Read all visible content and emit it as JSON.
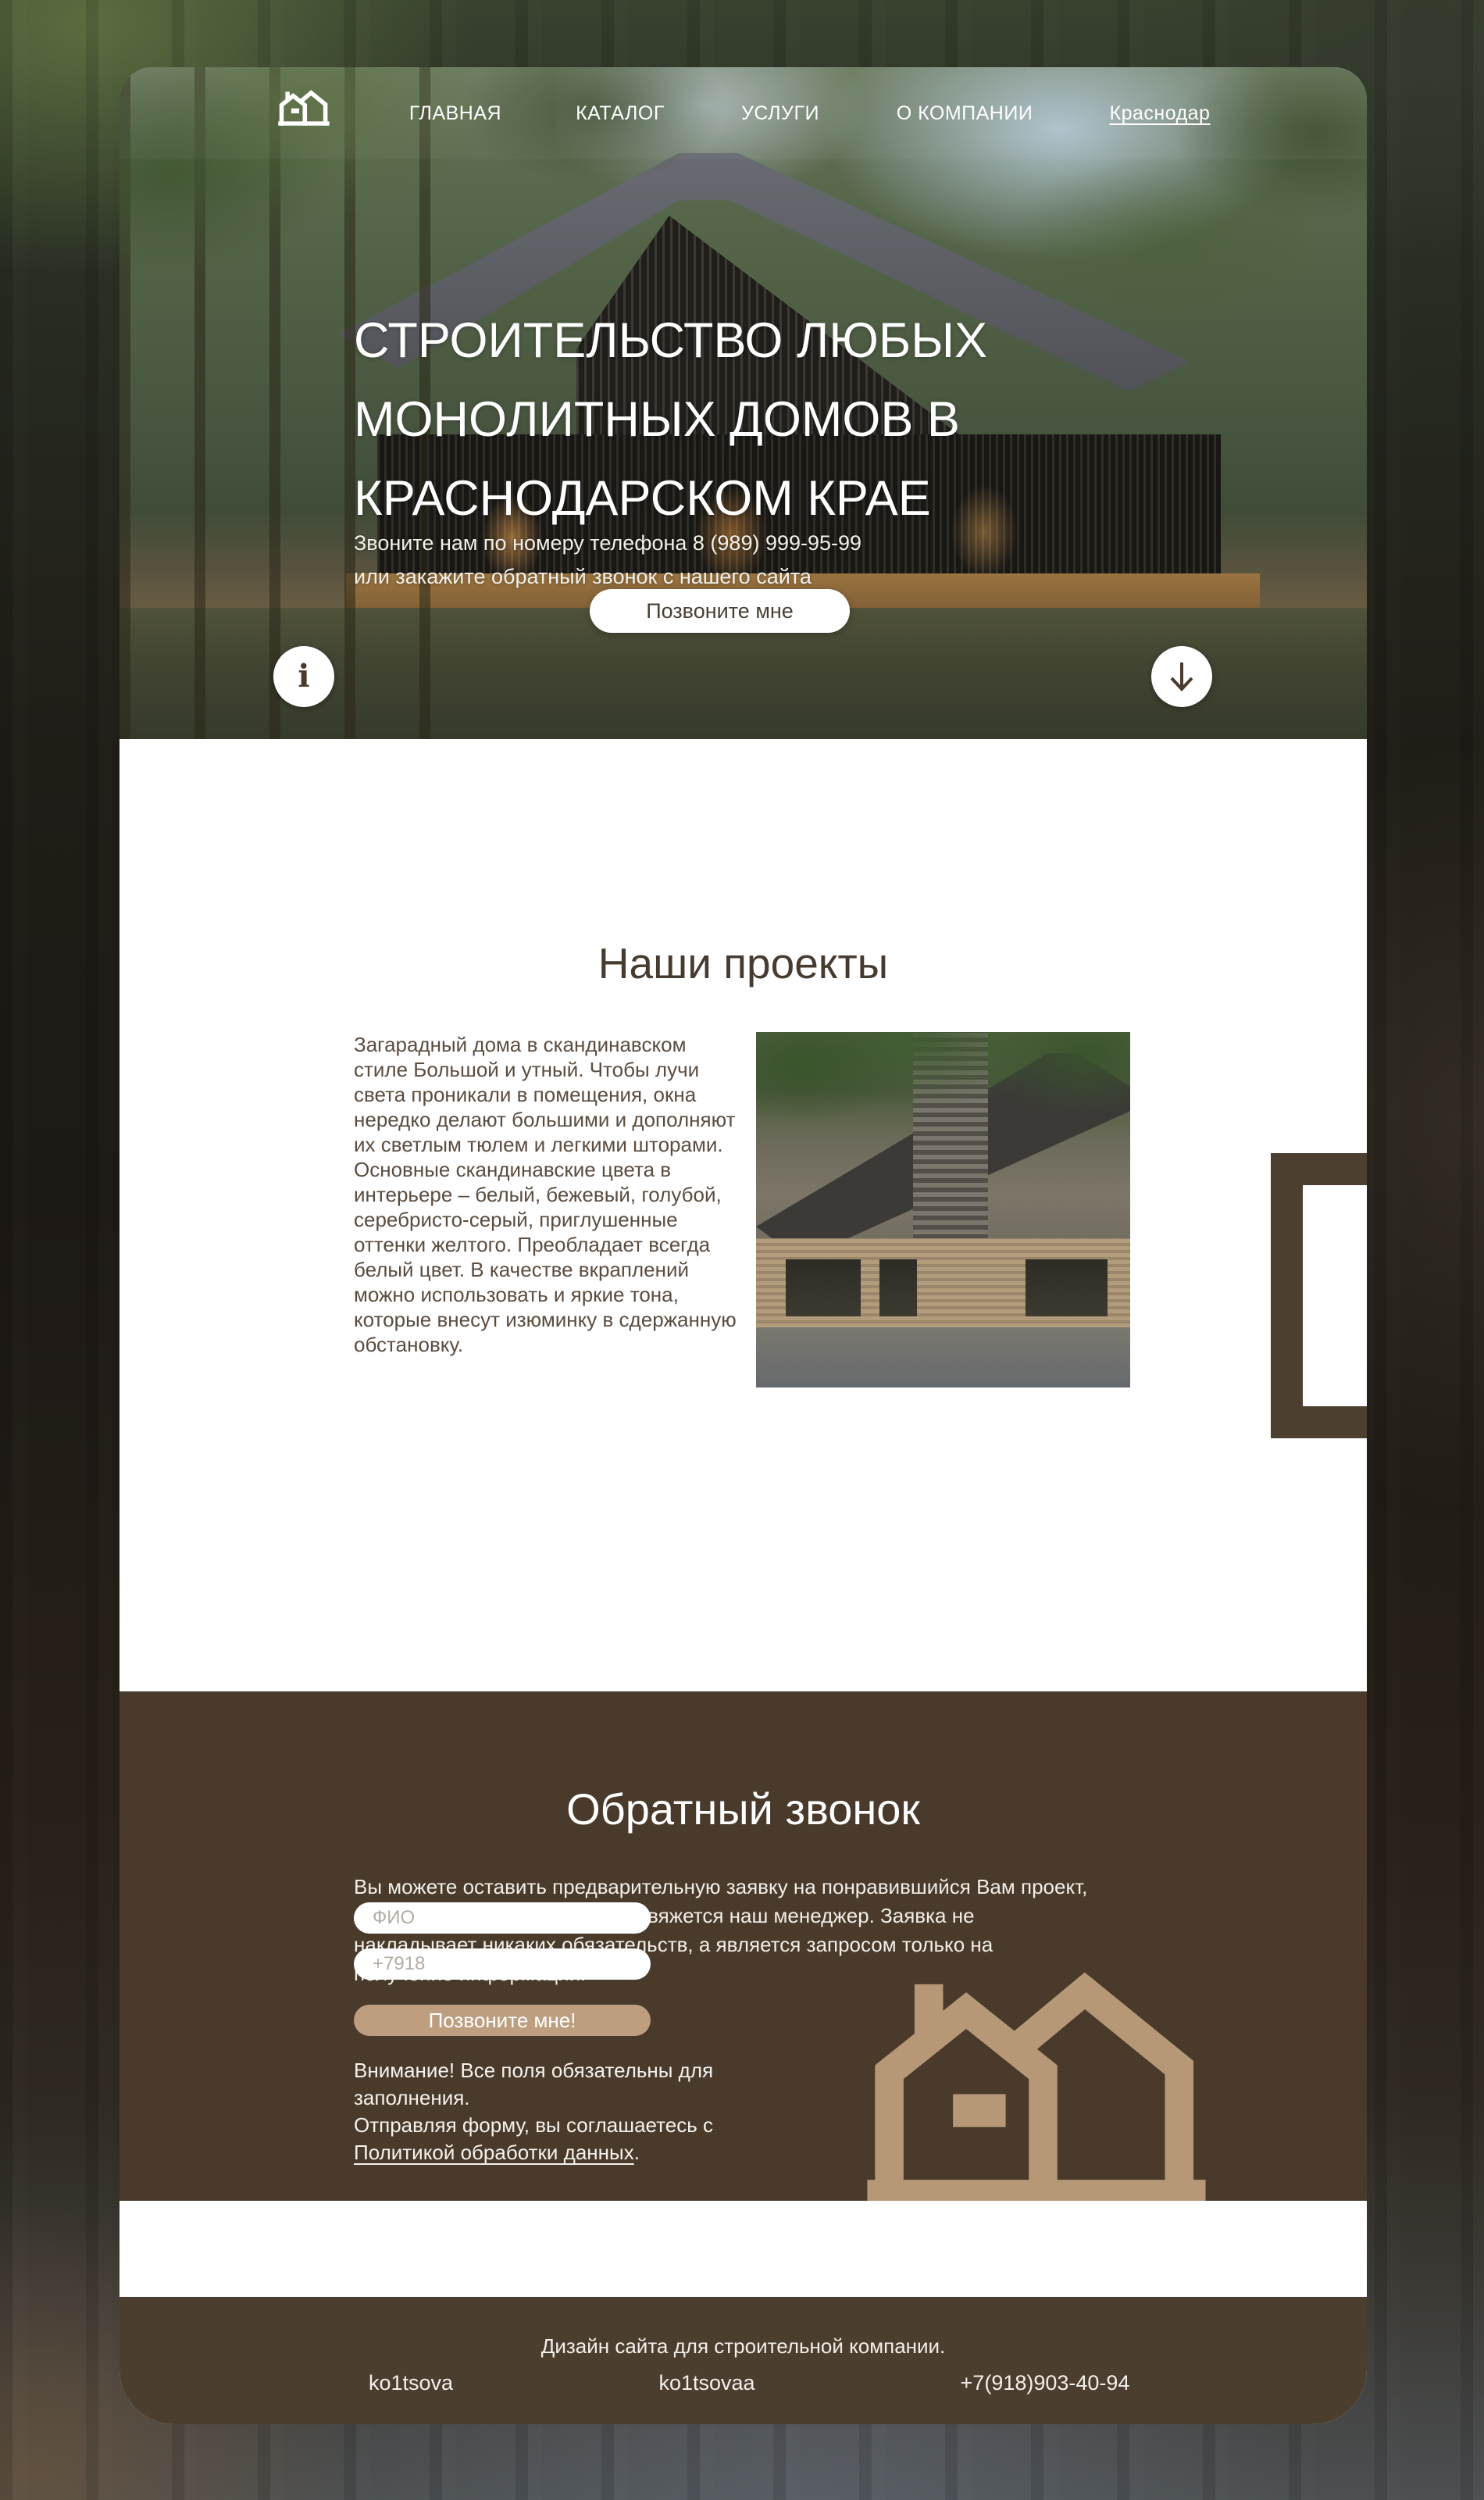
{
  "nav": {
    "items": [
      {
        "label": "ГЛАВНАЯ"
      },
      {
        "label": "КАТАЛОГ"
      },
      {
        "label": "УСЛУГИ"
      },
      {
        "label": "О КОМПАНИИ"
      }
    ],
    "city": "Краснодар"
  },
  "hero": {
    "title_lines": [
      "СТРОИТЕЛЬСТВО ЛЮБЫХ",
      "МОНОЛИТНЫХ ДОМОВ В",
      "КРАСНОДАРСКОМ КРАЕ"
    ],
    "subtitle_lines": [
      "Звоните нам по номеру телефона 8 (989) 999-95-99",
      "или закажите обратный звонок с нашего сайта"
    ],
    "cta_label": "Позвоните мне",
    "info_glyph": "i"
  },
  "projects": {
    "title": "Наши проекты",
    "description": "Загарадный дома в скандинавском стиле Большой и утный. Чтобы лучи света проникали в помещения, окна нередко делают большими и дополняют их светлым тюлем и легкими шторами. Основные скандинавские цвета в интерьере – белый, бежевый, голубой, серебристо-серый, приглушенные оттенки желтого. Преобладает всегда белый цвет. В качестве вкраплений можно использовать и яркие тона, которые внесут изюминку в сдержанную обстановку.",
    "counter": "01 - 08",
    "feature_icons": [
      "house-icon",
      "family-icon",
      "garage-icon"
    ]
  },
  "callback": {
    "title": "Обратный звонок",
    "description": "Вы можете оставить предварительную заявку на понравившийся Вам проект, и в ближайшее время с Вами свяжется наш менеджер. Заявка не накладывает никаких обязательств, а является запросом только на получение информации.",
    "form": {
      "name_placeholder": "ФИО",
      "phone_placeholder": "+7918",
      "submit_label": "Позвоните мне!"
    },
    "note_line1": "Внимание! Все поля обязательны для заполнения.",
    "note_prefix": "Отправляя форму, вы соглашаетесь с ",
    "note_link": "Политикой обработки данных",
    "note_suffix": "."
  },
  "footer": {
    "caption": "Дизайн сайта для строительной компании.",
    "author1": "ko1tsova",
    "author2": "ko1tsovaa",
    "phone": "+7(918)903-40-94"
  },
  "colors": {
    "brand_dark_brown": "#493a2b",
    "brand_beige": "#b69877",
    "button_beige": "#bd9e7f",
    "heading_brown": "#473b2f",
    "counter_beige": "#b1957a",
    "card_white": "#ffffff"
  }
}
